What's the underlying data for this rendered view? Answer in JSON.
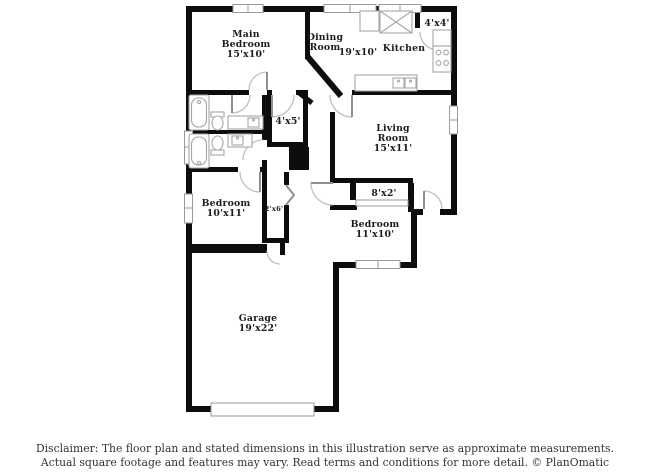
{
  "colors": {
    "wall": "#0d0d0d",
    "fixture_outline": "#a6a6a6",
    "door_arc": "#bfbfbf",
    "label_text": "#1c1c1c",
    "disclaimer_text": "#333333",
    "background": "#ffffff"
  },
  "rooms": {
    "main_bedroom": {
      "l1": "Main",
      "l2": "Bedroom",
      "l3": "15'x10'"
    },
    "dining": {
      "l1": "Dining",
      "l2": "Room"
    },
    "great_room_dims": {
      "label": "19'x10'"
    },
    "kitchen": {
      "label": "Kitchen"
    },
    "closet_4x4": {
      "label": "4'x4'"
    },
    "closet_4x5": {
      "label": "4'x5'"
    },
    "living": {
      "l1": "Living",
      "l2": "Room",
      "l3": "15'x11'"
    },
    "closet_8x2": {
      "label": "8'x2'"
    },
    "bedroom2": {
      "l1": "Bedroom",
      "l2": "10'x11'"
    },
    "closet_2x6": {
      "label": "2'x6'"
    },
    "bedroom3": {
      "l1": "Bedroom",
      "l2": "11'x10'"
    },
    "garage": {
      "l1": "Garage",
      "l2": "19'x22'"
    }
  },
  "disclaimer": {
    "line1": "Disclaimer: The floor plan and stated dimensions in this illustration serve as approximate measurements.",
    "line2": "Actual square footage and features may vary. Read terms and conditions for more detail. © PlanOmatic"
  }
}
